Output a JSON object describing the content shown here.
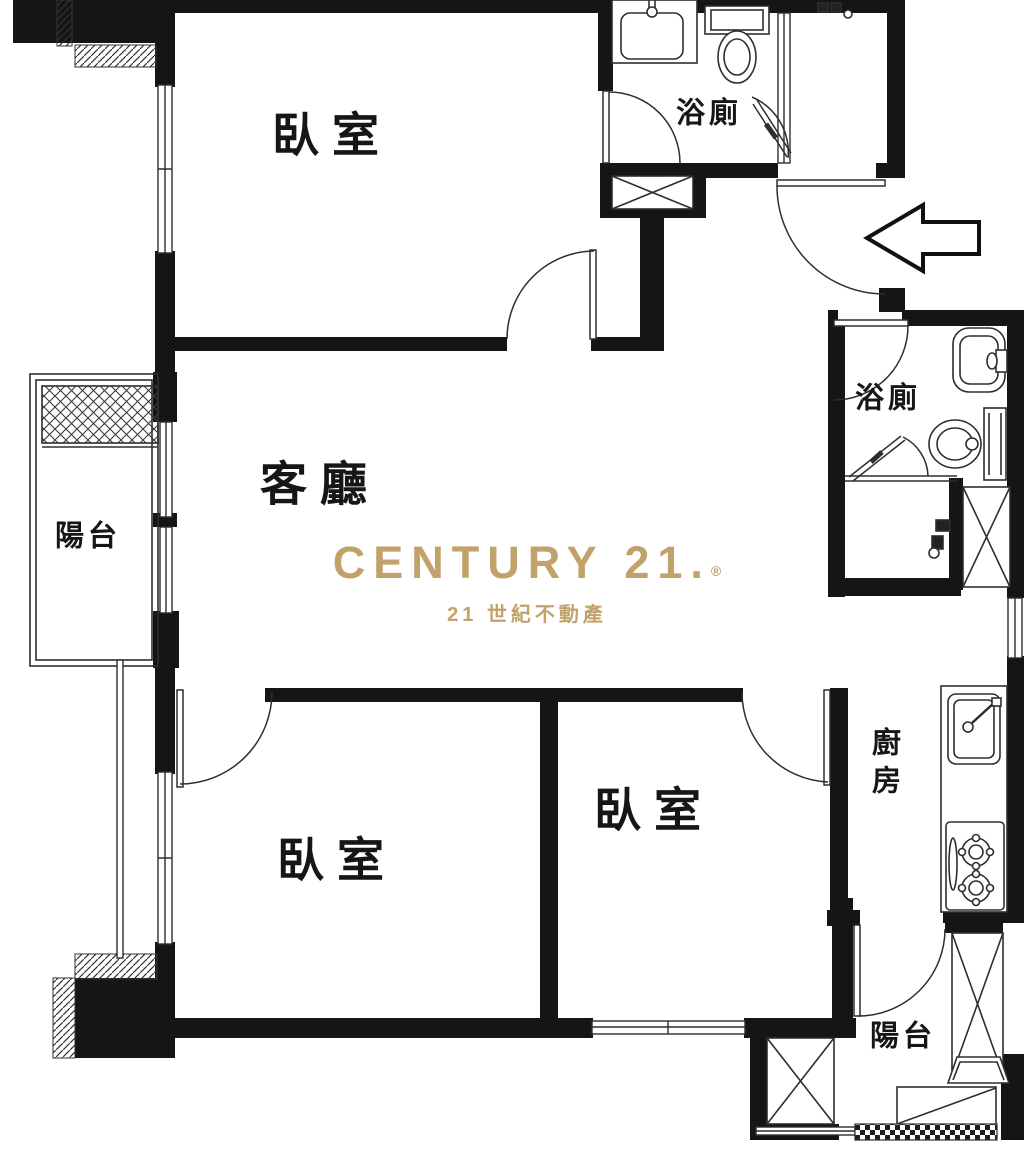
{
  "plan": {
    "rooms": [
      {
        "id": "bedroom-top",
        "label": "臥室"
      },
      {
        "id": "bathroom-top",
        "label": "浴廁"
      },
      {
        "id": "living-room",
        "label": "客廳"
      },
      {
        "id": "balcony-left",
        "label": "陽台"
      },
      {
        "id": "bathroom-right",
        "label": "浴廁"
      },
      {
        "id": "kitchen",
        "label": "廚房"
      },
      {
        "id": "bedroom-left",
        "label": "臥室"
      },
      {
        "id": "bedroom-middle",
        "label": "臥室"
      },
      {
        "id": "balcony-bottom",
        "label": "陽台"
      }
    ],
    "logo": {
      "brand": "CENTURY 21.",
      "registered": "®",
      "subtitle": "21 世紀不動產",
      "gold": "#c1a26b"
    },
    "colors": {
      "wall": "#151515",
      "line": "#2e2e2e",
      "background": "#ffffff"
    }
  }
}
